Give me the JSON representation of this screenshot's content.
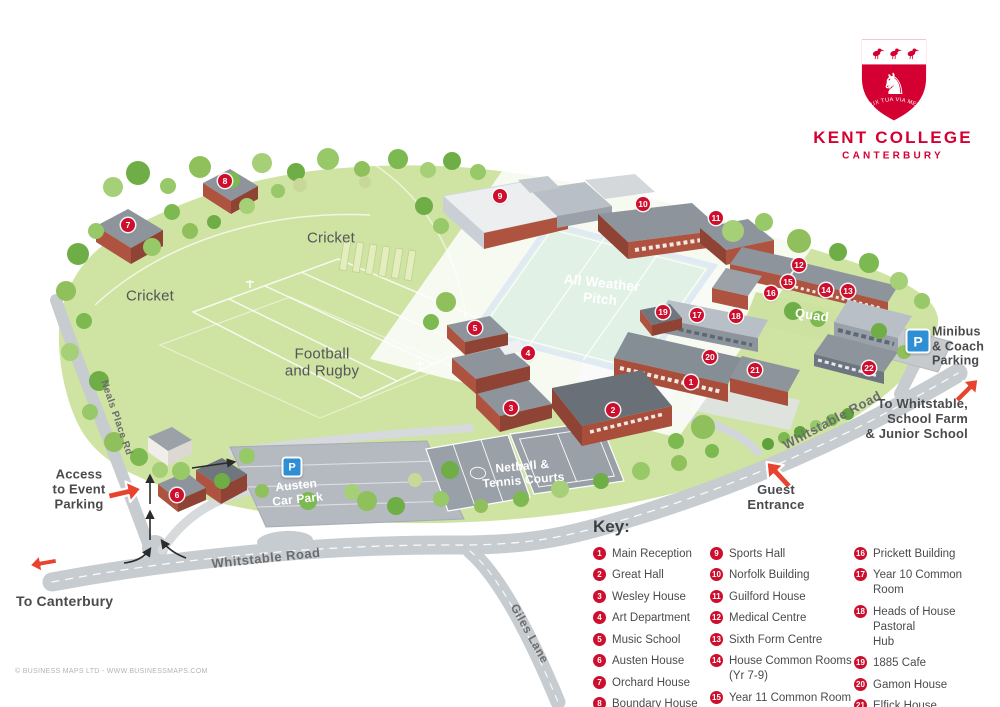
{
  "logo": {
    "name": "KENT COLLEGE",
    "city": "CANTERBURY",
    "motto": "LUX TUA VIA MEA"
  },
  "key": {
    "title": "Key:",
    "columns": [
      [
        {
          "n": "1",
          "label": "Main Reception"
        },
        {
          "n": "2",
          "label": "Great Hall"
        },
        {
          "n": "3",
          "label": "Wesley House"
        },
        {
          "n": "4",
          "label": "Art Department"
        },
        {
          "n": "5",
          "label": "Music School"
        },
        {
          "n": "6",
          "label": "Austen House"
        },
        {
          "n": "7",
          "label": "Orchard House"
        },
        {
          "n": "8",
          "label": "Boundary House"
        }
      ],
      [
        {
          "n": "9",
          "label": "Sports Hall"
        },
        {
          "n": "10",
          "label": "Norfolk Building"
        },
        {
          "n": "11",
          "label": "Guilford House"
        },
        {
          "n": "12",
          "label": "Medical Centre"
        },
        {
          "n": "13",
          "label": "Sixth Form Centre"
        },
        {
          "n": "14",
          "label": "House Common Rooms\n(Yr 7-9)"
        },
        {
          "n": "15",
          "label": "Year 11 Common Room"
        }
      ],
      [
        {
          "n": "16",
          "label": "Prickett Building"
        },
        {
          "n": "17",
          "label": "Year 10 Common Room"
        },
        {
          "n": "18",
          "label": "Heads of House Pastoral\nHub"
        },
        {
          "n": "19",
          "label": "1885 Cafe"
        },
        {
          "n": "20",
          "label": "Gamon House"
        },
        {
          "n": "21",
          "label": "Elfick House"
        },
        {
          "n": "22",
          "label": "The Arch Drop Off"
        }
      ]
    ]
  },
  "map_labels": {
    "cricket_left": "Cricket",
    "cricket_right": "Cricket",
    "football_rugby": "Football\nand Rugby",
    "all_weather_pitch": "All Weather\nPitch",
    "quad": "Quad",
    "netball_tennis": "Netball &\nTennis Courts",
    "austen_car_park": "Austen\nCar Park",
    "minibus_parking": "Minibus\n& Coach\nParking",
    "whitstable_road_bottom": "Whitstable Road",
    "whitstable_road_right": "Whitstable Road",
    "neals_place_rd": "Neals Place Rd",
    "giles_lane": "Giles Lane",
    "to_canterbury": "To Canterbury",
    "access_event_parking": "Access\nto Event\nParking",
    "guest_entrance": "Guest\nEntrance",
    "to_whitstable": "To Whitstable,\nSchool Farm\n& Junior School"
  },
  "badges": {
    "parking_symbol": "P"
  },
  "map_markers": [
    {
      "n": "1",
      "x": 691,
      "y": 382
    },
    {
      "n": "2",
      "x": 613,
      "y": 410
    },
    {
      "n": "3",
      "x": 511,
      "y": 408
    },
    {
      "n": "4",
      "x": 528,
      "y": 353
    },
    {
      "n": "5",
      "x": 475,
      "y": 328
    },
    {
      "n": "6",
      "x": 177,
      "y": 495
    },
    {
      "n": "7",
      "x": 128,
      "y": 225
    },
    {
      "n": "8",
      "x": 225,
      "y": 181
    },
    {
      "n": "9",
      "x": 500,
      "y": 196
    },
    {
      "n": "10",
      "x": 643,
      "y": 204
    },
    {
      "n": "11",
      "x": 716,
      "y": 218
    },
    {
      "n": "12",
      "x": 799,
      "y": 265
    },
    {
      "n": "13",
      "x": 848,
      "y": 291
    },
    {
      "n": "14",
      "x": 826,
      "y": 290
    },
    {
      "n": "15",
      "x": 788,
      "y": 282
    },
    {
      "n": "16",
      "x": 771,
      "y": 293
    },
    {
      "n": "17",
      "x": 697,
      "y": 315
    },
    {
      "n": "18",
      "x": 736,
      "y": 316
    },
    {
      "n": "19",
      "x": 663,
      "y": 312
    },
    {
      "n": "20",
      "x": 710,
      "y": 357
    },
    {
      "n": "21",
      "x": 755,
      "y": 370
    },
    {
      "n": "22",
      "x": 869,
      "y": 368
    }
  ],
  "copyright": "© BUSINESS MAPS LTD - WWW.BUSINESSMAPS.COM",
  "colors": {
    "crimson_marker": "#ce0e2d",
    "logo_red": "#d50032",
    "arrow_red": "#e8432e",
    "field_green": "#cfe3a2",
    "pitch_green": "#3ba25b",
    "pitch_blue": "#2c73b8",
    "road_gray": "#c7ccd0",
    "parking_blue": "#2e8fd5",
    "label_gray": "#55565a",
    "dark_text": "#4a4b4d"
  }
}
